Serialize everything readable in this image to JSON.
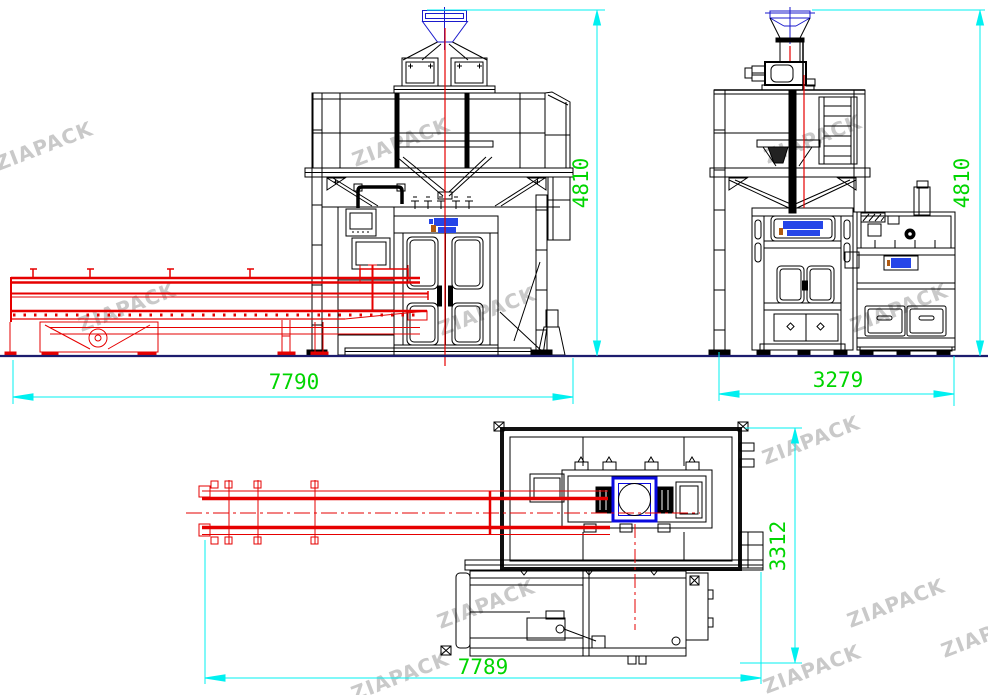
{
  "watermark": {
    "text": "ZIAPACK"
  },
  "dimensions": {
    "front_width": "7790",
    "front_height": "4810",
    "side_width": "3279",
    "side_height": "4810",
    "plan_length": "7789",
    "plan_depth": "3312"
  },
  "colors": {
    "line_black": "#000000",
    "conveyor_red": "#e60000",
    "dimension_cyan": "#00f0f0",
    "dimension_text_green": "#00d500",
    "ground_navy": "#1c1c6e",
    "hopper_blue": "#1a1acc",
    "logo_blue": "#2545e8",
    "plan_square_blue": "#0a0ae0",
    "accent_orange": "#b05a10",
    "watermark_gray": "#c9c9c9"
  }
}
